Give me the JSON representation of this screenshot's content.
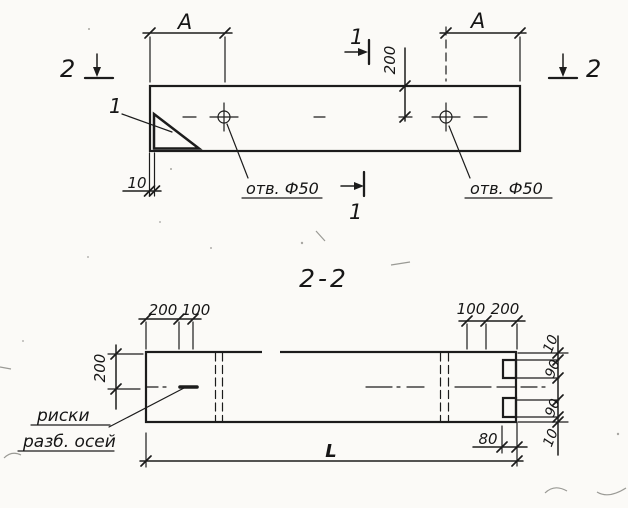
{
  "meta": {
    "ink_color": "#1c1c1c",
    "paper_color": "#fbfaf7",
    "drawing_type": "precast panel working drawing, plan and section"
  },
  "plan_view": {
    "dim_span_left": "A",
    "dim_span_right": "A",
    "dim_hole_offset": "200",
    "dim_edge_offset": "10",
    "hole_note_left": "отв. Ф50",
    "hole_note_right": "отв. Ф50",
    "section1_top": "1",
    "section1_bottom": "1",
    "section2_left": "2",
    "section2_right": "2",
    "detail_mark": "1"
  },
  "section_view": {
    "title": "2-2",
    "dim_left_height": "200",
    "dim_top_left_200": "200",
    "dim_top_left_100": "100",
    "dim_top_right_100": "100",
    "dim_top_right_200": "200",
    "chain_top_10": "10",
    "chain_90_a": "90",
    "chain_90_b": "90",
    "chain_bottom_10": "10",
    "dim_notch_depth": "80",
    "dim_total_length": "L",
    "axis_note_line1": "риски",
    "axis_note_line2": "разб. осей"
  }
}
